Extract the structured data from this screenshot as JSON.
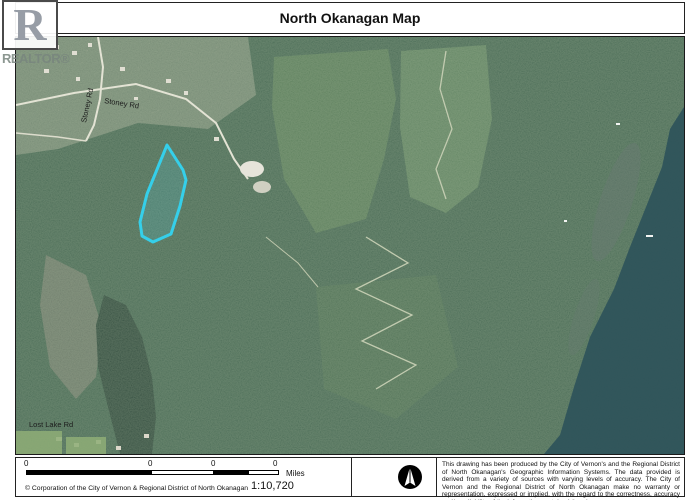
{
  "window": {
    "title": "North Okanagan Map"
  },
  "logo": {
    "letter": "R",
    "label": "REALTOR®"
  },
  "map": {
    "road_labels": {
      "stoney_horizontal": "Stoney Rd",
      "stoney_vertical": "Stoney Rd",
      "lost_lake": "Lost Lake Rd"
    },
    "parcel": {
      "outline_color": "#35CFEA"
    }
  },
  "footer": {
    "scalebar": {
      "ticks": [
        "0",
        "0",
        "0",
        "0"
      ],
      "unit": "Miles"
    },
    "scale_ratio": "1:10,720",
    "copyright": "© Corporation of the City of Vernon & Regional District of North Okanagan",
    "disclaimer": "This drawing has been produced by the City of Vernon's and the Regional District of North Okanagan's Geographic Information Systems. The data provided is derived from a variety of sources with varying levels of accuracy. The City of Vernon and the Regional District of North Okanagan make no warranty or representation, expressed or implied, with the regard to the correctness, accuracy and/or reliability of the information contained therein."
  }
}
